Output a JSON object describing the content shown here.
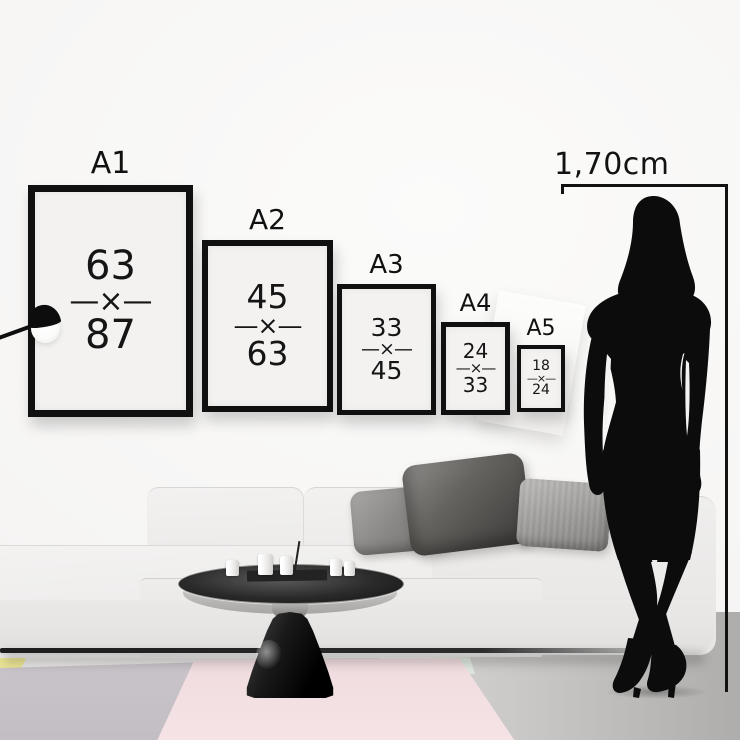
{
  "height_marker": {
    "label": "1,70cm"
  },
  "frames": [
    {
      "label": "A1",
      "w": "63",
      "sep": "—×—",
      "h": "87"
    },
    {
      "label": "A2",
      "w": "45",
      "sep": "—×—",
      "h": "63"
    },
    {
      "label": "A3",
      "w": "33",
      "sep": "—×—",
      "h": "45"
    },
    {
      "label": "A4",
      "w": "24",
      "sep": "—×—",
      "h": "33"
    },
    {
      "label": "A5",
      "w": "18",
      "sep": "—×—",
      "h": "24"
    }
  ],
  "colors": {
    "wall": "#f5f4f3",
    "floor": "#c9c8c6",
    "frame_border": "#101010",
    "frame_paper": "#f3f2f1",
    "text": "#141414",
    "silhouette": "#0c0c0c",
    "sofa": "#ededec",
    "pillow_dark": "#595857",
    "pillow_mid": "#8b8a88",
    "pillow_light": "#a3a2a0",
    "rug_pink": "#f2dee1",
    "rug_gray": "#c7c2c7",
    "rug_mint": "#dfe7e0",
    "accent_yellow": "#ece596",
    "table_glass": "#1e1e1e"
  }
}
